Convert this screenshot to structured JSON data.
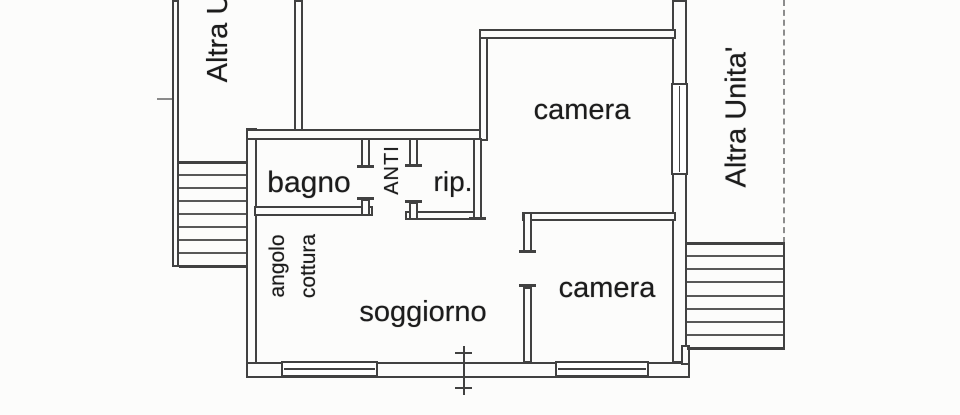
{
  "plan": {
    "kind": "scanned apartment floor plan",
    "labels": {
      "camera_top": "camera",
      "camera_bottom": "camera",
      "soggiorno": "soggiorno",
      "bagno": "bagno",
      "rip": "rip.",
      "anti": "ANTI",
      "angolo_cottura_line1": "angolo",
      "angolo_cottura_line2": "cottura",
      "altra_unita_left": "Altra U",
      "altra_unita_right": "Altra Unita'"
    },
    "stairs": {
      "left": {
        "steps": 9
      },
      "right": {
        "steps": 9
      }
    }
  },
  "colors": {
    "wall": "#414141",
    "text": "#1c1c1c",
    "background": "#fcfcfb",
    "boundary_dash": "#8c8c8c"
  }
}
